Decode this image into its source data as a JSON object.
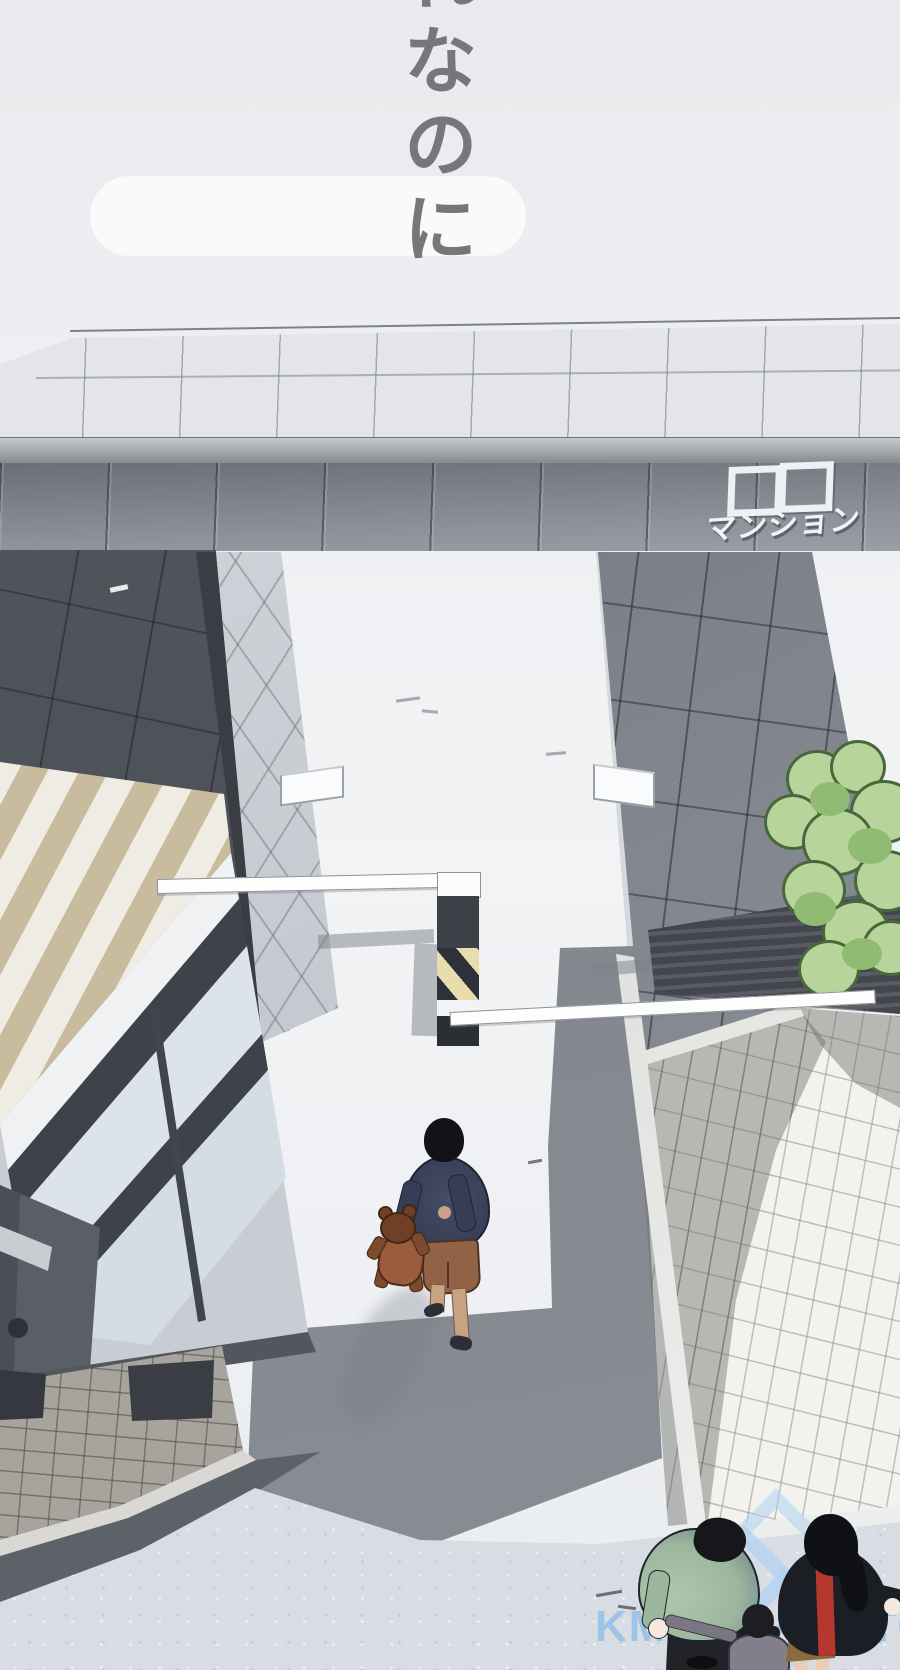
{
  "dialogue": {
    "text": "れなのに"
  },
  "gate_sign": {
    "squares": "□□",
    "label": "マンション"
  },
  "watermark": {
    "text": "KMANGANATO.COM"
  },
  "palette": {
    "background_light": "#eef0f3",
    "gate_dark_gray": "#53575e",
    "gate_mid_gray": "#8e929a",
    "roof_tan": "#c9bb9e",
    "hazard_yellow": "#e8ddae",
    "hazard_dark": "#2e3138",
    "shadow_gray": "#878b92",
    "bush_green_light": "#b7d59b",
    "bush_green_mid": "#8fbb72",
    "sweater_navy": "#3a4158",
    "shorts_brown": "#926246",
    "bear_brown": "#9a5c3c",
    "man_jacket_green": "#a3bba9",
    "woman_red": "#b5382e",
    "woman_skirt_brown": "#8a6a3f",
    "concrete_blue_gray": "#d8dce3",
    "watermark_blue": "#a9cfee"
  }
}
